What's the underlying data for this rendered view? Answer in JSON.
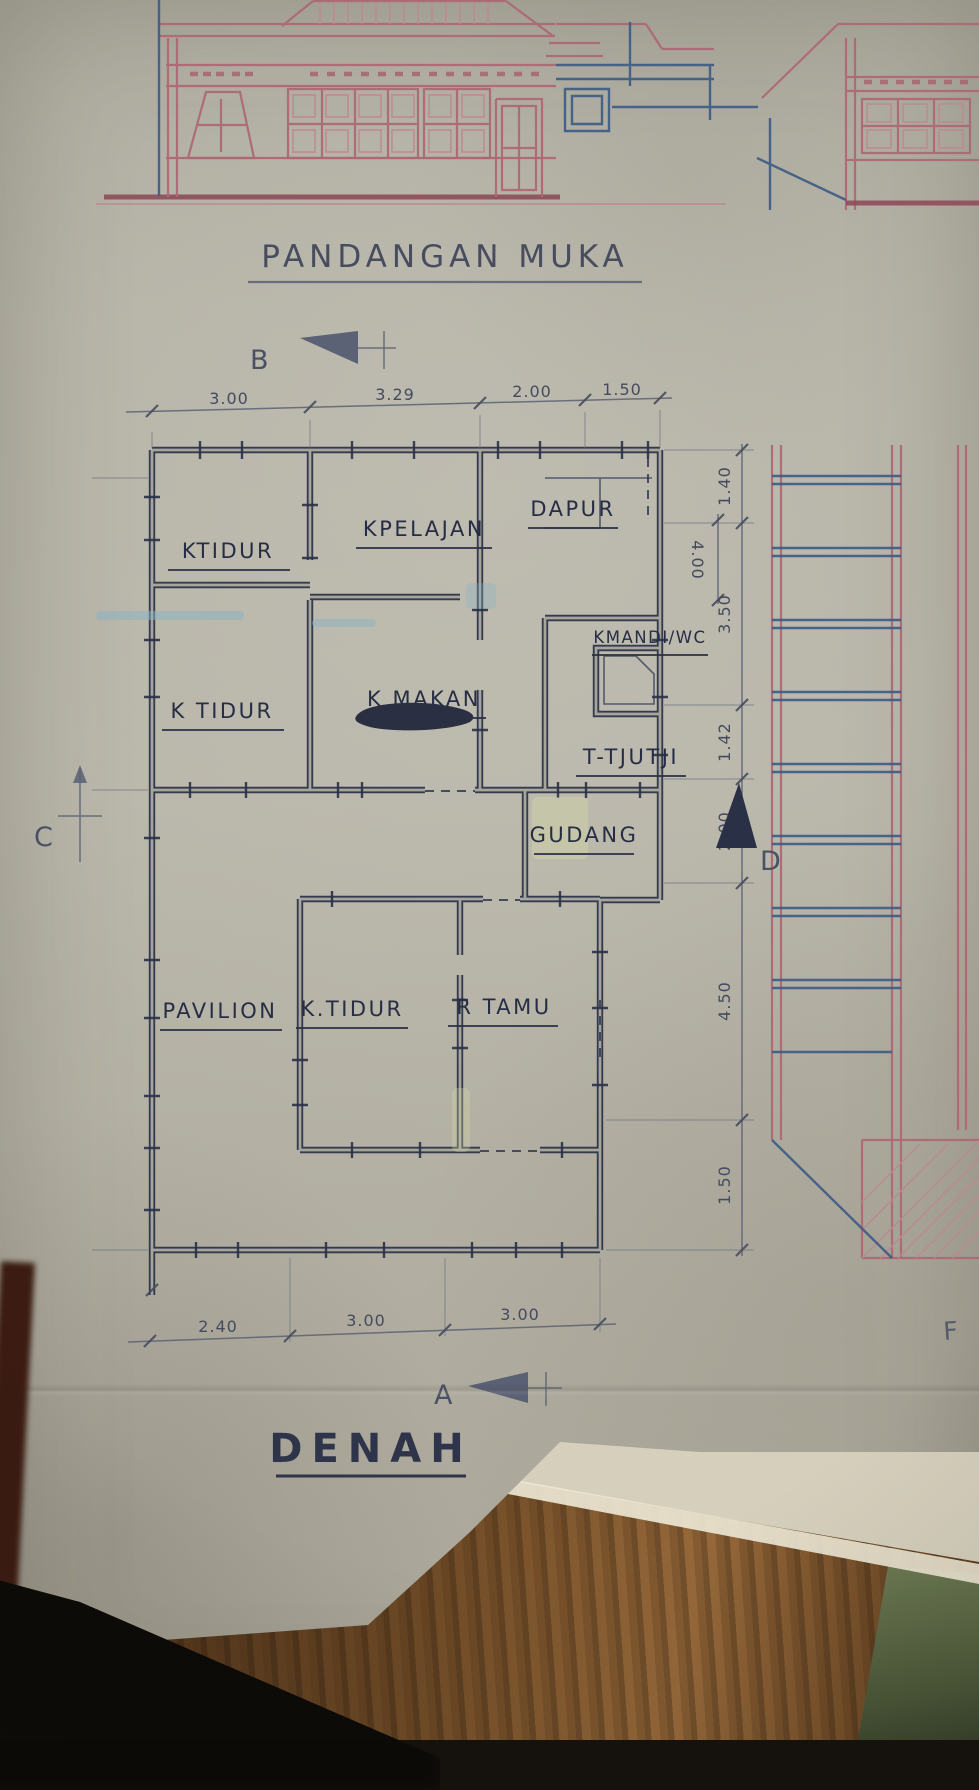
{
  "titles": {
    "elevation": "PANDANGAN MUKA",
    "plan": "DENAH"
  },
  "markers": {
    "top": "B",
    "bottom": "A",
    "left": "C",
    "right": "D"
  },
  "dims": {
    "top": [
      "3.00",
      "3.29",
      "2.00",
      "1.50"
    ],
    "right": [
      "1.40",
      "3.50",
      "1.42",
      "2.00",
      "4.50",
      "1.50"
    ],
    "bottom": [
      "2.40",
      "3.00",
      "3.00"
    ],
    "inner": "4.00"
  },
  "rooms": {
    "k_tidur_1": "KTIDUR",
    "k_pelajan": "KPELAJAN",
    "dapur": "DAPUR",
    "k_tidur_2": "K TIDUR",
    "k_makan": "K MAKAN",
    "k_mandi": "KMANDI/WC",
    "t_tjutji": "T-TJUTJI",
    "gudang": "GUDANG",
    "pavilion": "PAVILION",
    "k_tidur_3": "K.TIDUR",
    "r_tamu": "R TAMU"
  },
  "annotations": {
    "letter_f": "F"
  },
  "colors": {
    "paper": "#b4b1a5",
    "plan_ink": "#2a3147",
    "pink_ink": "#ad6875",
    "blue_ink": "#3c5a85",
    "pencil": "#5b6073",
    "wood": "#6e4a26",
    "green_object": "#556140"
  }
}
